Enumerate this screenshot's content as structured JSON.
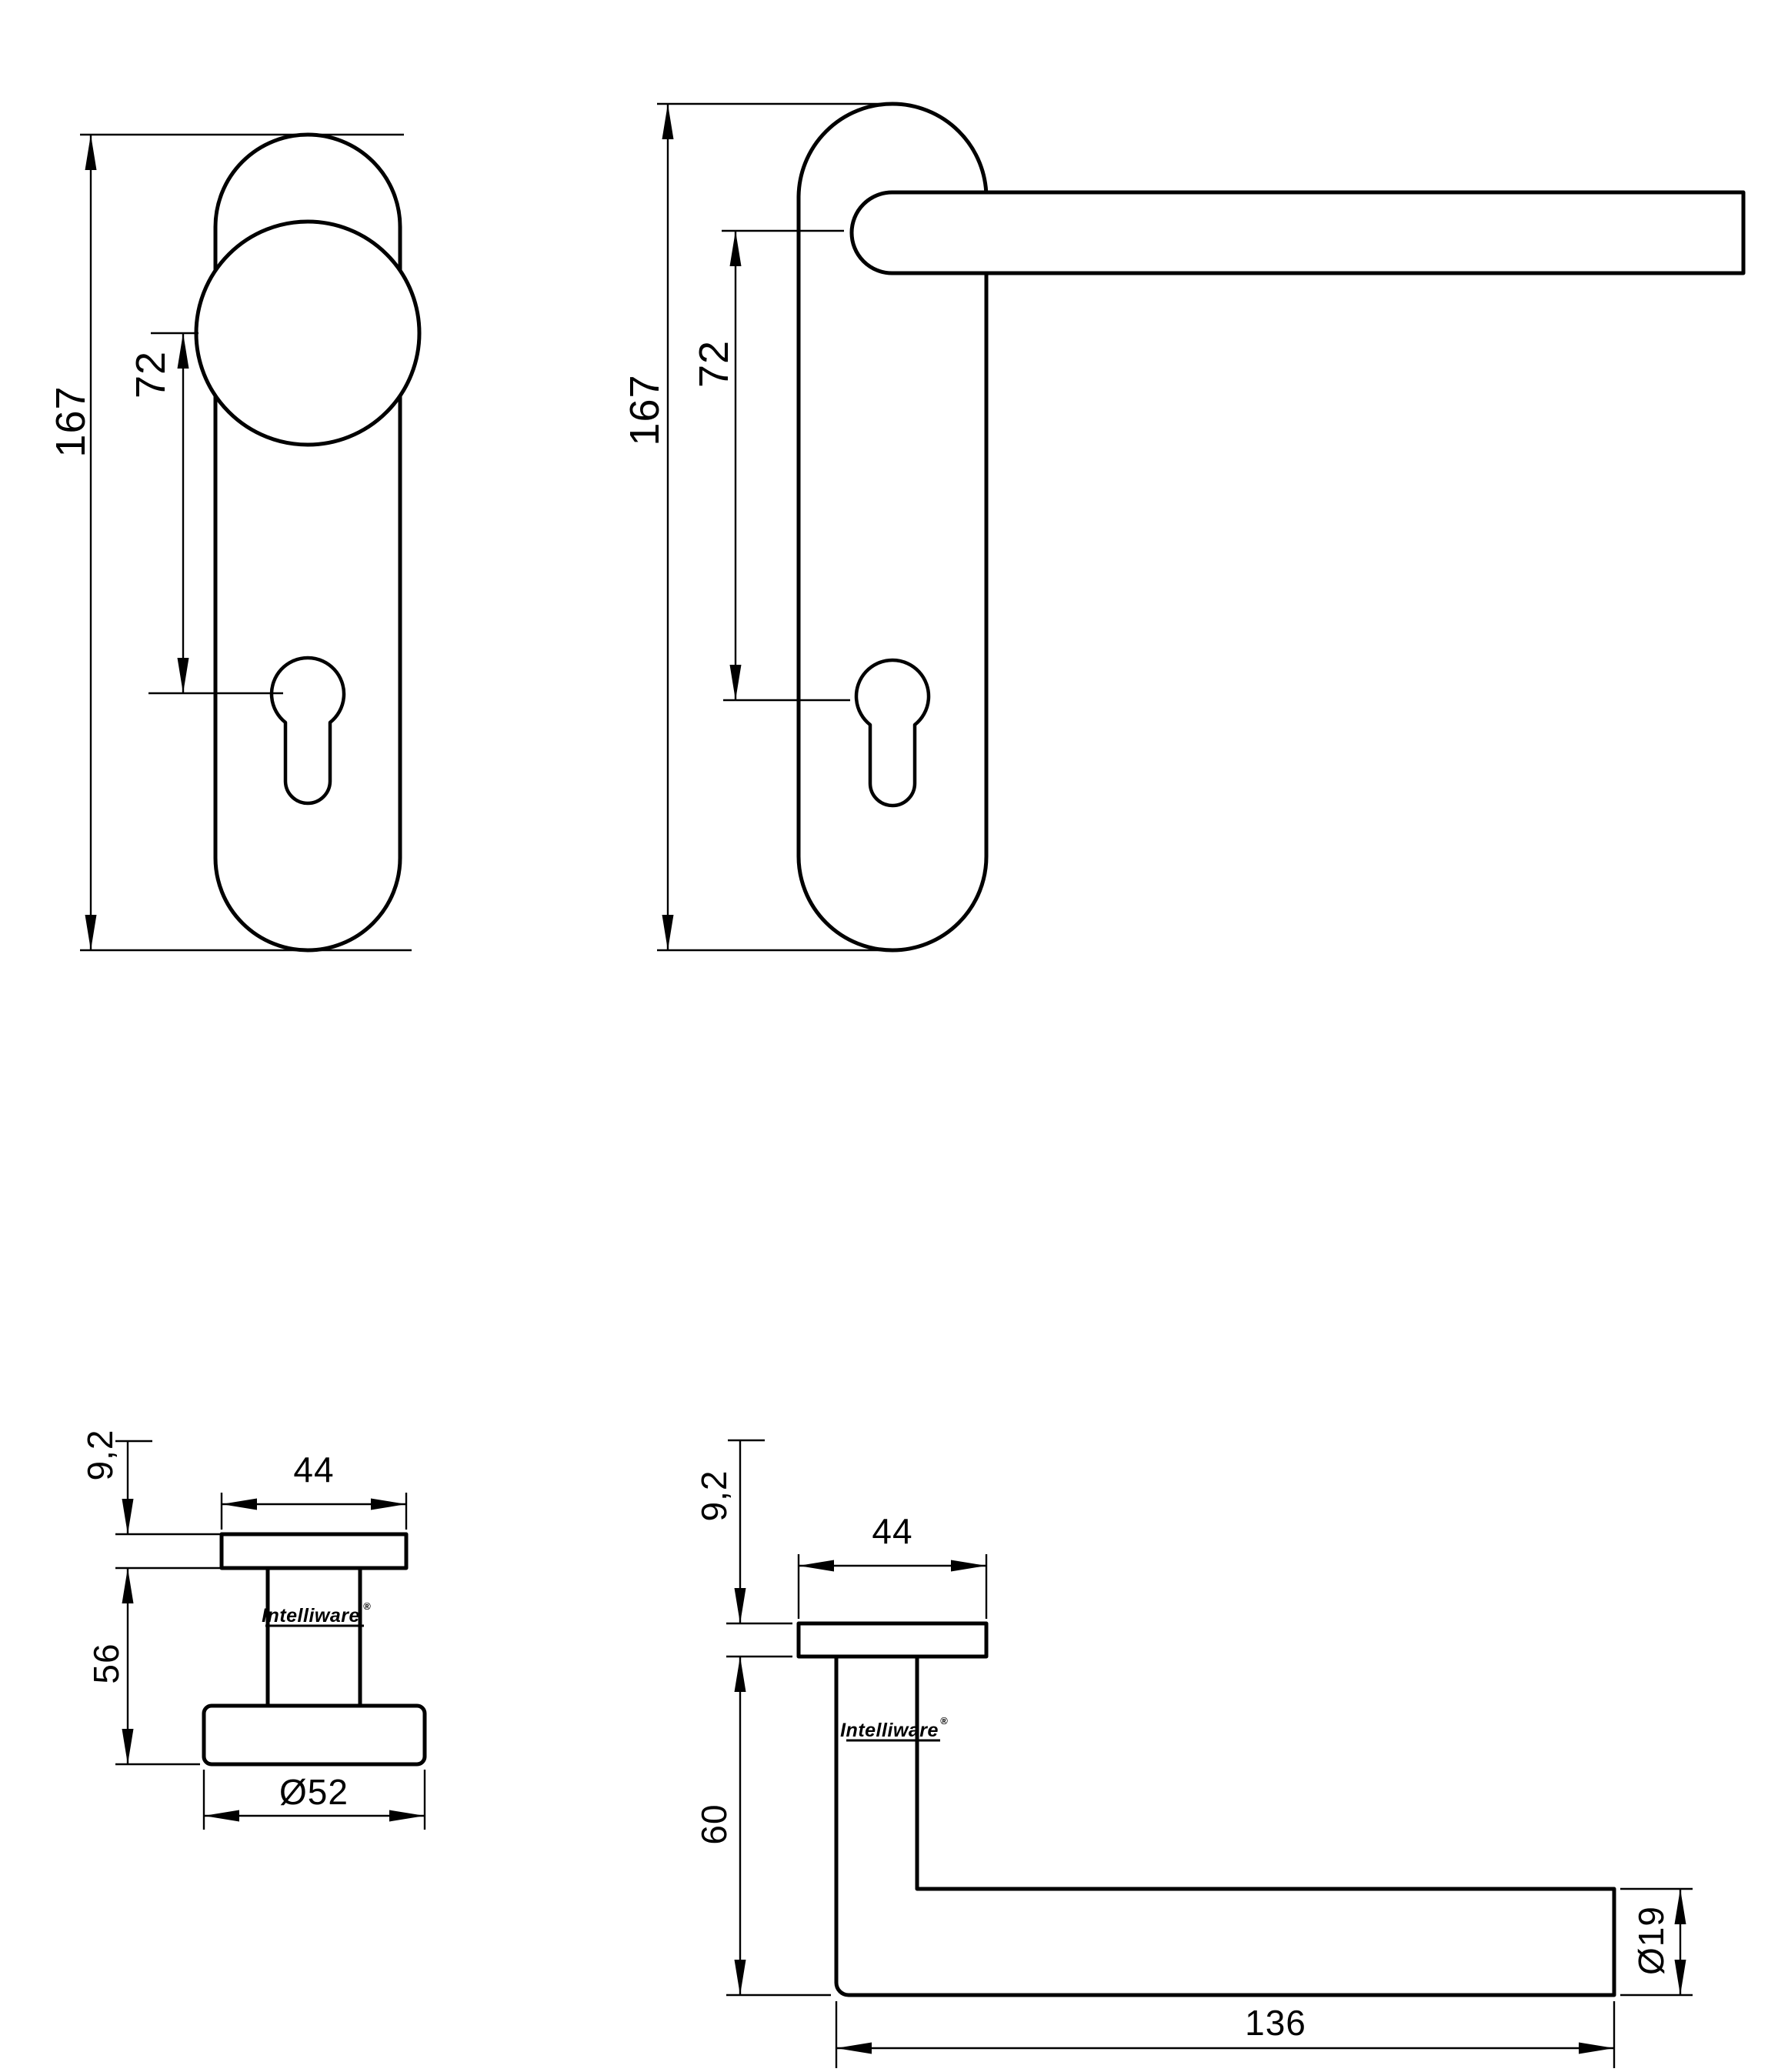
{
  "canvas": {
    "background": "#ffffff",
    "ink": "#000000"
  },
  "brand": {
    "name": "Intelliware",
    "mark": "®"
  },
  "knob_front": {
    "height": "167",
    "centers": "72"
  },
  "lever_front": {
    "height": "167",
    "centers": "72"
  },
  "knob_side": {
    "thickness": "9,2",
    "width": "44",
    "projection": "56",
    "diameter": "Ø52"
  },
  "lever_side": {
    "thickness": "9,2",
    "width": "44",
    "projection": "60",
    "length": "136",
    "diameter": "Ø19"
  }
}
